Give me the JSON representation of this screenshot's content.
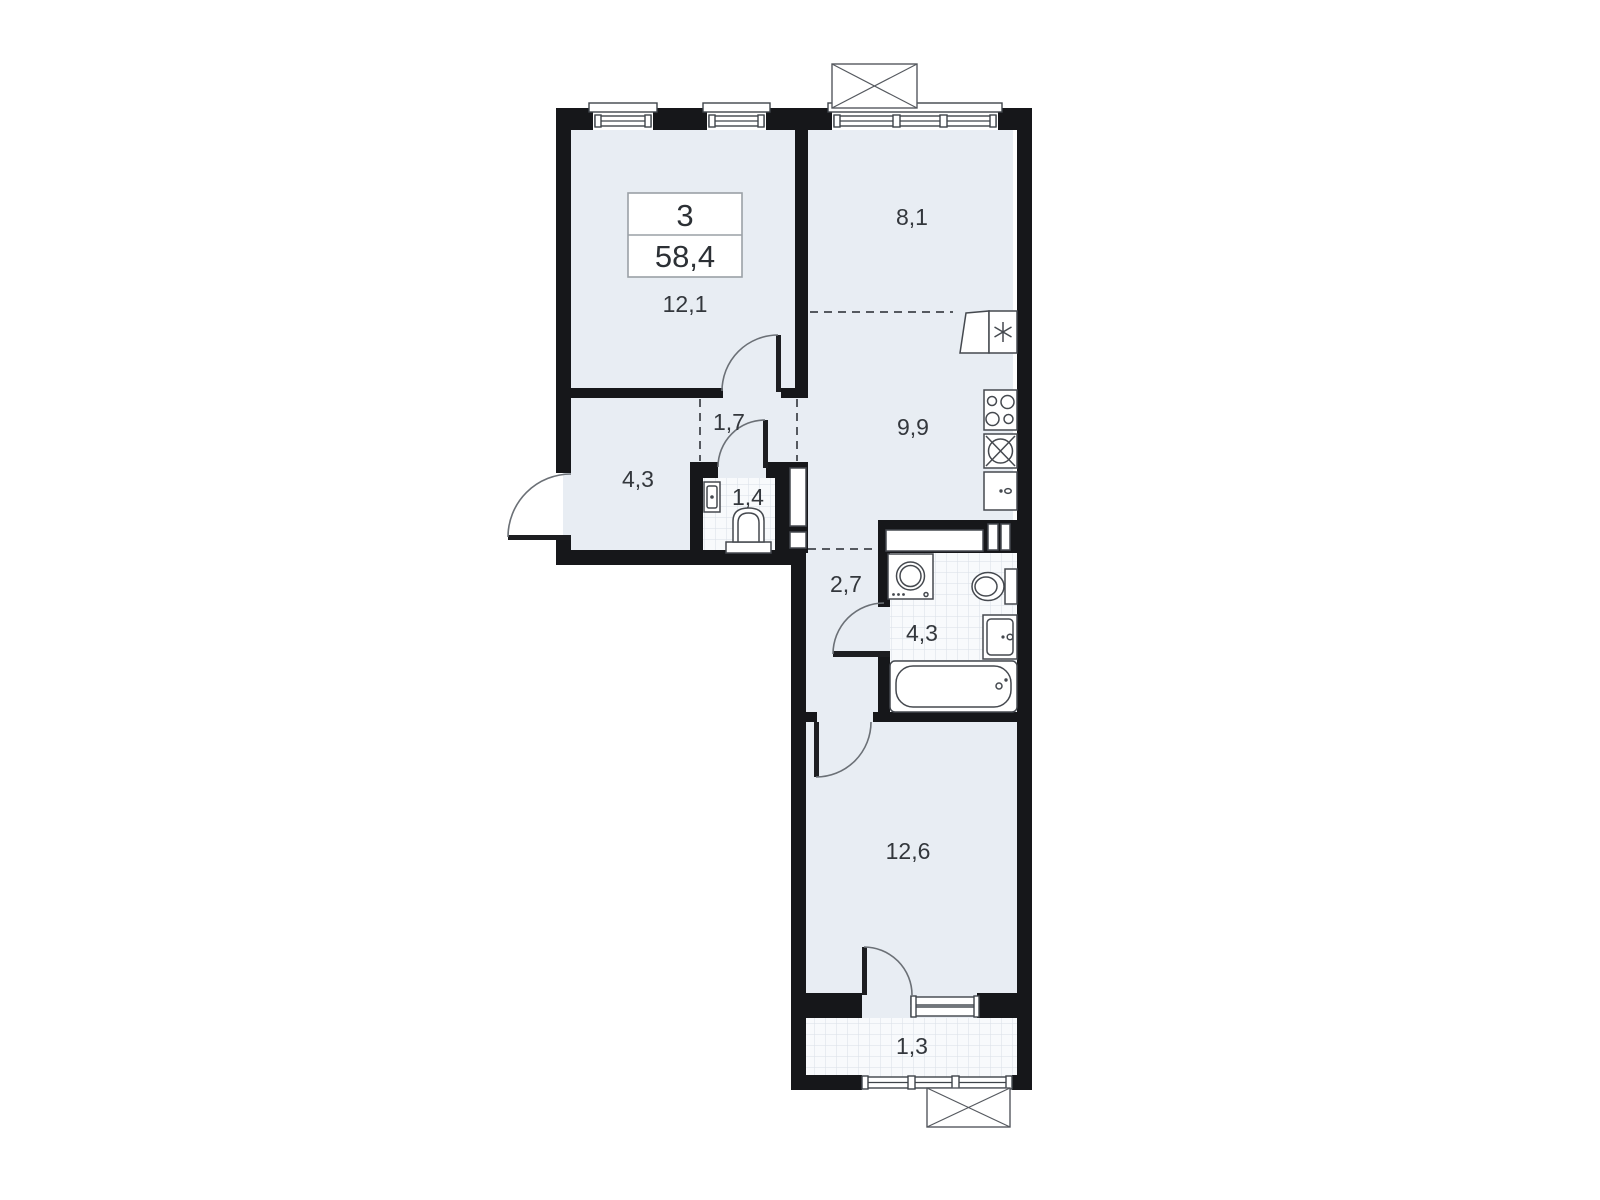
{
  "plan": {
    "unit": {
      "room_count": "3",
      "total_area": "58,4"
    },
    "rooms": [
      {
        "name": "living-room",
        "area": "12,1"
      },
      {
        "name": "room-top-right",
        "area": "8,1"
      },
      {
        "name": "hall",
        "area": "1,7"
      },
      {
        "name": "entry-hallway",
        "area": "4,3"
      },
      {
        "name": "wc",
        "area": "1,4"
      },
      {
        "name": "kitchen",
        "area": "9,9"
      },
      {
        "name": "corridor",
        "area": "2,7"
      },
      {
        "name": "bathroom",
        "area": "4,3"
      },
      {
        "name": "bedroom",
        "area": "12,6"
      },
      {
        "name": "balcony",
        "area": "1,3"
      }
    ],
    "colors": {
      "wall": "#16171a",
      "room_floor": "#e8edf3",
      "tile_floor": "#f8fafc",
      "tile_grid": "#d9dfe6",
      "fixture_line": "#45494f",
      "label_text": "#33373c",
      "background": "#ffffff"
    }
  }
}
